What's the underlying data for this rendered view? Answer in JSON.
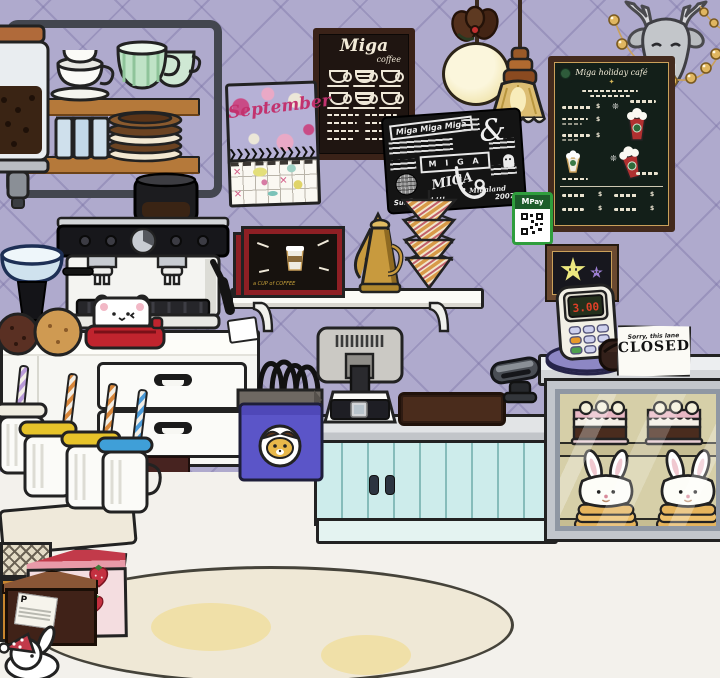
{
  "colors": {
    "wall": "#afaacd",
    "floor": "#f3f1ec",
    "bag_purple": "#5b55c8",
    "counter_blue": "#cdeceb",
    "menu_board_green": "#131f19",
    "frame_brown": "#432a1d",
    "mpay_green": "#2f9e3d",
    "toaster_red": "#c0242e",
    "register_digits": "#e24028"
  },
  "wall_art": {
    "coffee_board": {
      "title": "Miga",
      "subtitle": "coffee"
    },
    "calendar": {
      "month": "September",
      "spiral": "❯❯❯❯❯❯❯❯❯❯❯❯",
      "x_mark": "✕"
    },
    "band_poster": {
      "banner": "Miga Miga Miga",
      "ampersand": "&",
      "boxed_title": "M I G A",
      "brush_title": "MIGA",
      "caption_left": "Surfboard !!!",
      "caption_right": "Migaland",
      "year": "2007"
    },
    "holiday_menu": {
      "title": "Miga holiday café",
      "star": "✦",
      "snowflake": "❊",
      "price_mark": "$"
    },
    "coffee_print": {
      "caption": "a CUP of COFFEE"
    },
    "mpay_sign": {
      "logo": "M",
      "label": "Pay"
    }
  },
  "checkout": {
    "register_display": "3.00",
    "closed_sign": {
      "line1": "Sorry, this lane",
      "line2": "CLOSED"
    }
  },
  "storage": {
    "strawberry_box_label": "rry",
    "box_icon_up": "↥",
    "box_icon_fragile": "∥",
    "shipping_label_letter": "P"
  }
}
